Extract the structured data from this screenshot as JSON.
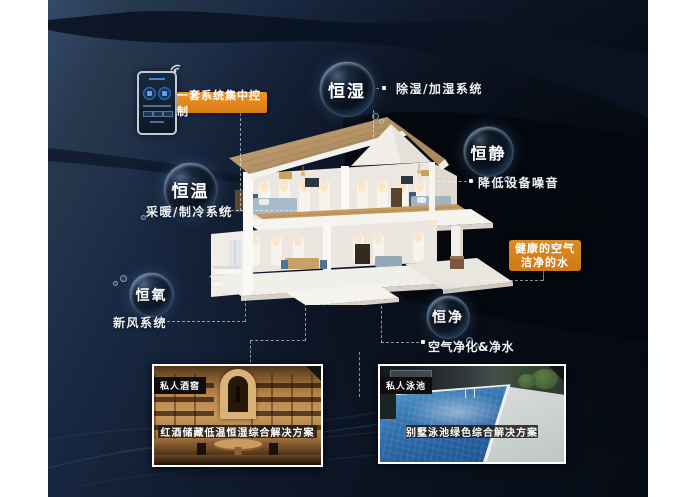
{
  "background": {
    "base": "#16243a",
    "dark": "#060b14",
    "light_band": "#35496a"
  },
  "control_panel": {
    "label": "一套系统集中控制",
    "accent": "#e0851e"
  },
  "bubbles": [
    {
      "label": "恒湿",
      "feature": "除湿/加湿系统"
    },
    {
      "label": "恒静",
      "feature": "降低设备噪音"
    },
    {
      "label": "恒温",
      "feature": "采暖/制冷系统"
    },
    {
      "label": "恒氧",
      "feature": "新风系统"
    },
    {
      "label": "恒净",
      "feature": "空气净化&净水"
    }
  ],
  "highlight_card": {
    "line1": "健康的空气",
    "line2": "洁净的水",
    "color": "#d9821f"
  },
  "photo_cards": [
    {
      "tag": "私人酒窖",
      "caption": "红酒储藏低温恒湿综合解决方案"
    },
    {
      "tag": "私人泳池",
      "caption": "别墅泳池绿色综合解决方案"
    }
  ]
}
